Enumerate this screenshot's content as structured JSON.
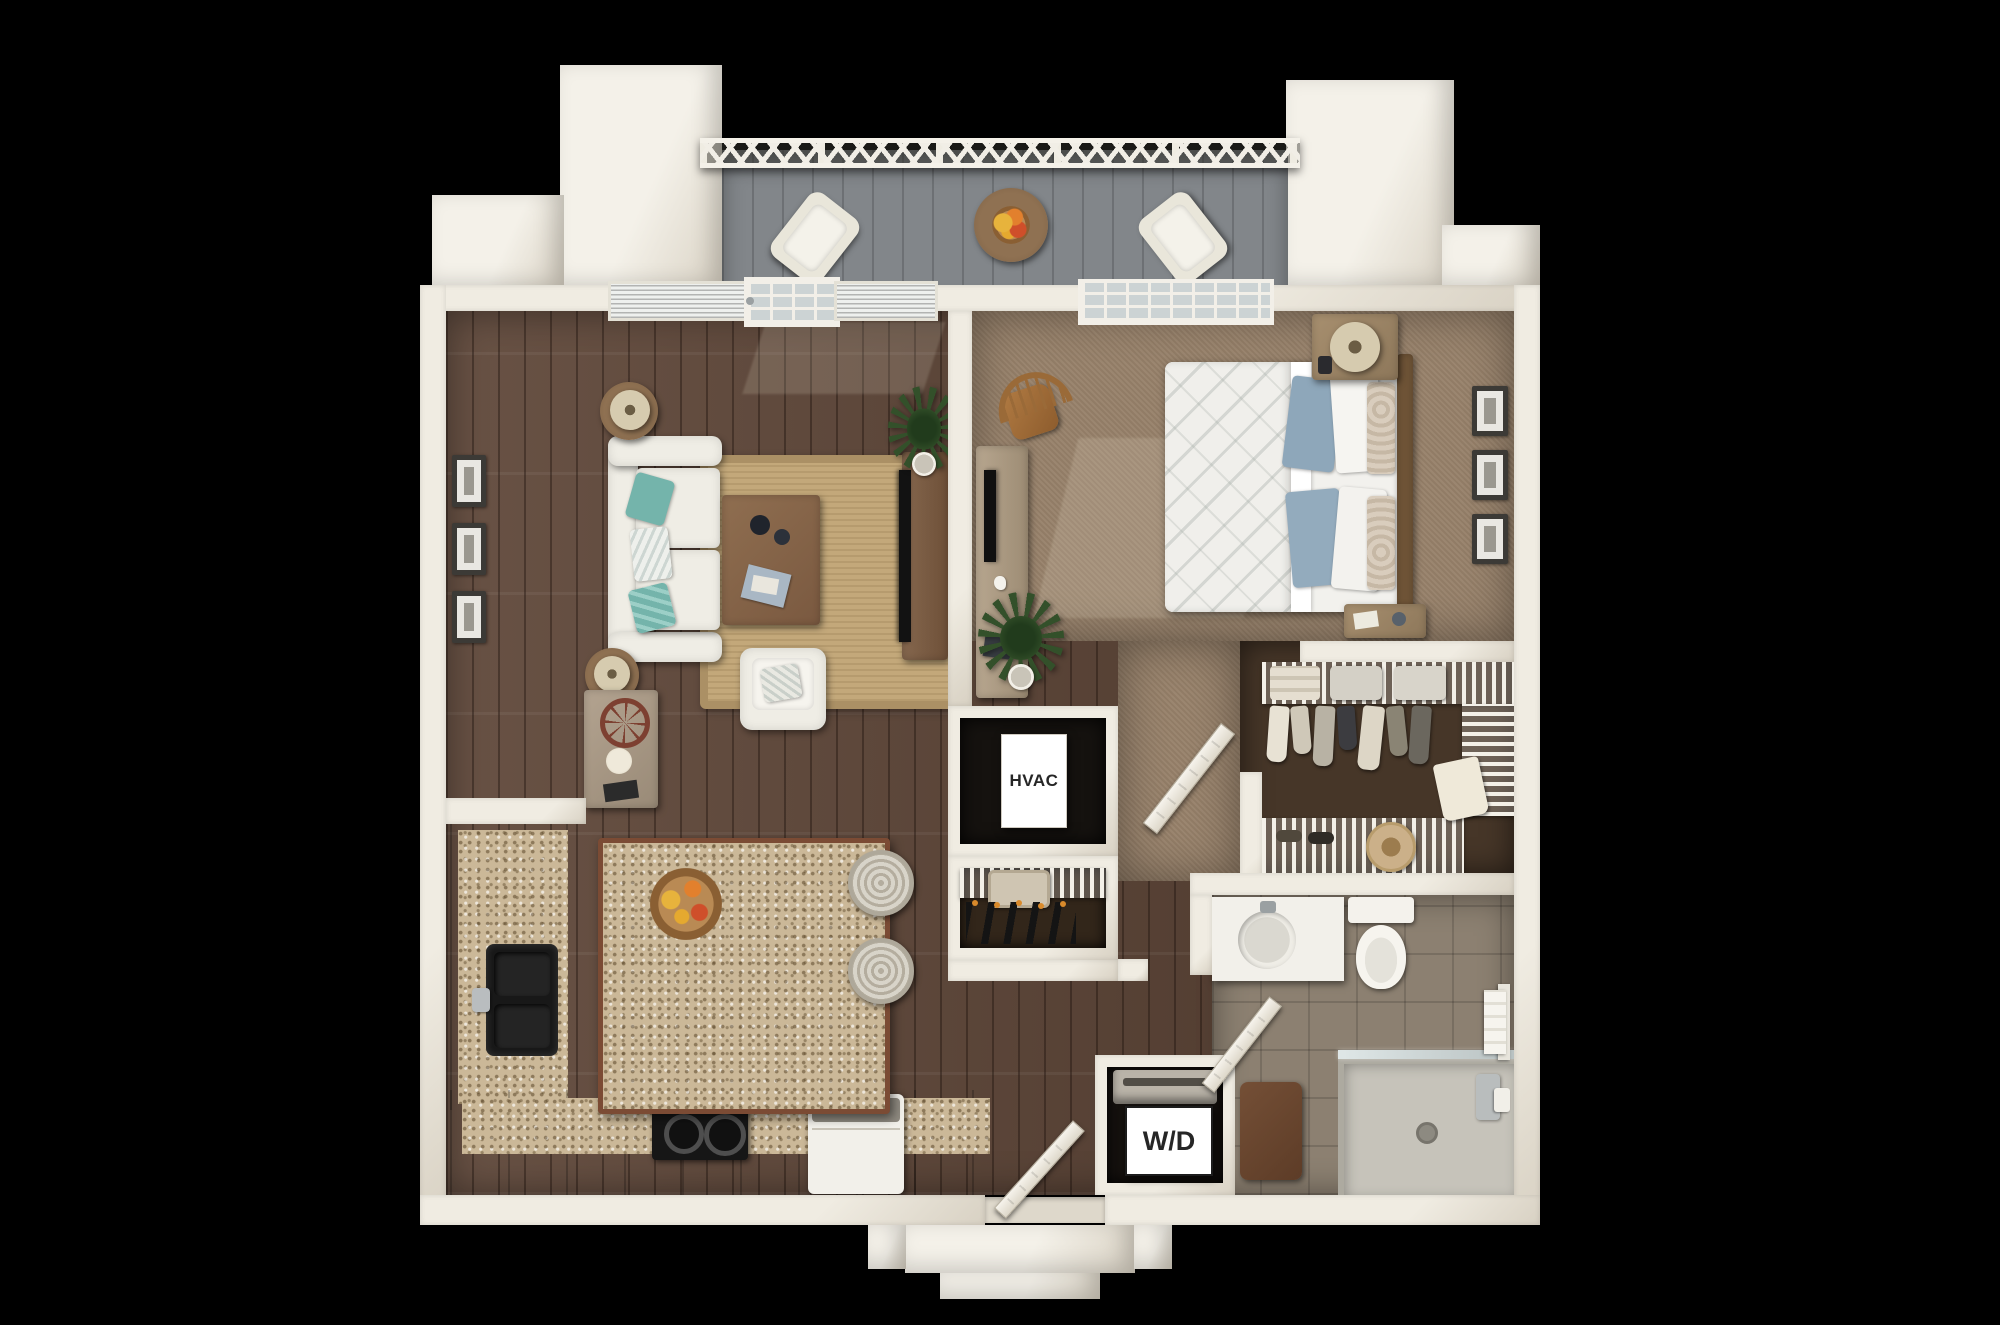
{
  "scene": {
    "type": "3d-floor-plan",
    "description": "Top-down 3D rendering of a one-bedroom, one-bath apartment with balcony, open living/kitchen area, walk-in closet, HVAC closet and stacked washer/dryer closet"
  },
  "labels": {
    "hvac": "HVAC",
    "washer_dryer": "W/D"
  },
  "colors": {
    "bg": "#000000",
    "wall": "#f0ece2",
    "wall-shade": "#d8d1c3",
    "wood": "#5f4739",
    "carpet": "#97816a",
    "carpet-dark": "#463628",
    "tile": "#8c8071",
    "balcony": "#82868a",
    "granite": "#cbb898",
    "cabinet": "#7d4b34",
    "rug": "#c3a87a",
    "sofa": "#efede5",
    "teal": "#74b4ab",
    "bed-blue": "#8ea7ba",
    "appliance": "#f2f0ea",
    "label-bg": "#ffffff",
    "label-text": "#262626"
  }
}
